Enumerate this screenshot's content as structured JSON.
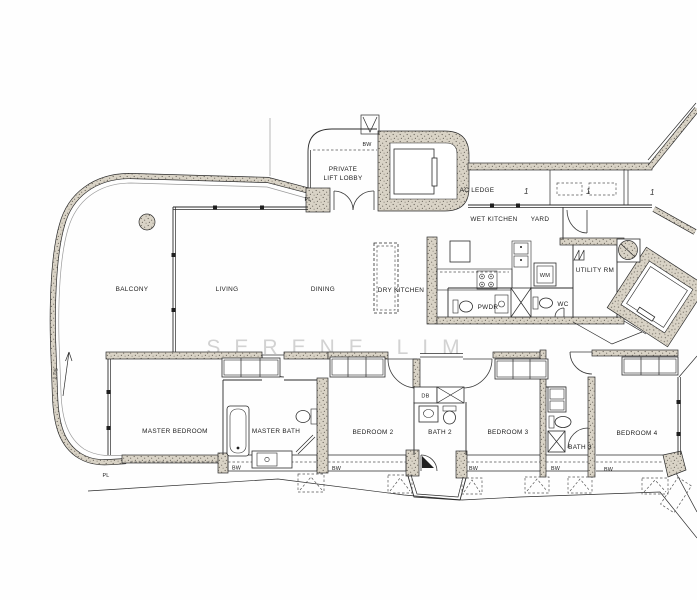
{
  "watermark": "SERENE LIM",
  "dimension_label": "1.05",
  "rooms": {
    "balcony": "BALCONY",
    "living": "LIVING",
    "dining": "DINING",
    "dry_kitchen": "DRY KITCHEN",
    "wet_kitchen": "WET KITCHEN",
    "yard": "YARD",
    "ac_ledge": "AC LEDGE",
    "lift_lobby_line1": "PRIVATE",
    "lift_lobby_line2": "LIFT LOBBY",
    "utility": "UTILITY RM",
    "pwdr": "PWDR",
    "wc": "WC",
    "wm": "WM",
    "db": "DB",
    "master_bedroom": "MASTER BEDROOM",
    "master_bath": "MASTER BATH",
    "bedroom2": "BEDROOM 2",
    "bath2": "BATH 2",
    "bedroom3": "BEDROOM 3",
    "bath3": "BATH 3",
    "bedroom4": "BEDROOM 4"
  },
  "markers": {
    "bw": "BW",
    "pl": "PL",
    "ac_unit": "1"
  }
}
